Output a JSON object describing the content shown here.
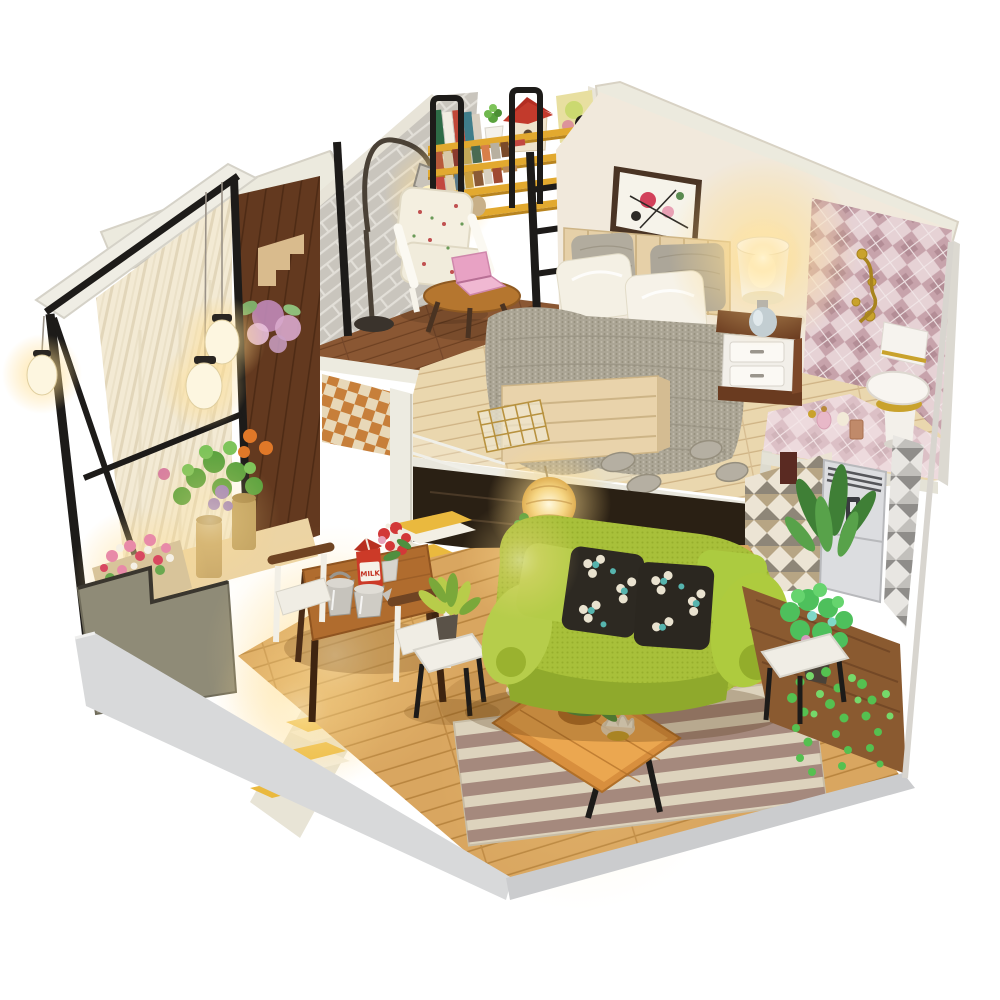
{
  "meta": {
    "type": "product-photo",
    "subject": "DIY miniature dollhouse kit — two-storey loft apartment with lights",
    "background": "#ffffff"
  },
  "labels": {
    "milk_carton": "MILK"
  },
  "palette": {
    "exterior_wall": "#eceade",
    "brick_wall": "#c9c5bd",
    "dark_wood_wall": "#63391f",
    "shelf_yellow": "#e2a92f",
    "frame_black": "#1d1b19",
    "bedroom_wall": "#f1e9dc",
    "argyle_tile_base": "#e6d2d5",
    "argyle_diamond": "#c7a3ab",
    "gold_fixture": "#c9a22c",
    "loft_wood": "#ead7ae",
    "nook_wood": "#8a5733",
    "floor_wood": "#d9a660",
    "stair_yellow": "#eab93e",
    "curtain_cream": "#f3ead4",
    "blanket_gray": "#aba595",
    "satin_white": "#f4f0e4",
    "sofa_green": "#a8c03a",
    "cushion_dark": "#2d2922",
    "cushion_flower_white": "#e9e2cf",
    "cushion_flower_teal": "#56b4ae",
    "rug_cream": "#ddd3bd",
    "rug_stripe": "#a5897d",
    "coffee_table": "#d88f3e",
    "milk_red": "#cc3a28",
    "kettle_silver": "#c6c3bc",
    "plant_green": "#57a93c",
    "vine_green": "#55c050",
    "ac_silver": "#dcdde0",
    "toilet_white": "#f6f3ee",
    "lamp_glow": "#ffd98a",
    "base_edge": "#d4d5d6"
  },
  "scene": {
    "areas": [
      {
        "name": "reading-nook",
        "objects": [
          "brick-wall",
          "bookshelf",
          "book-row",
          "succulent-pot",
          "red-birdhouse",
          "art-poster",
          "arc-floor-lamp",
          "floral-armchair",
          "round-side-table",
          "pink-laptop"
        ]
      },
      {
        "name": "bedroom-loft",
        "objects": [
          "abstract-wall-art",
          "slatted-bed",
          "knit-blanket",
          "knit-pillows",
          "satin-pillows",
          "nightstand",
          "table-lamp",
          "knit-slippers",
          "wire-basket",
          "pattern-rug",
          "guard-ladder",
          "acrylic-stair-rail"
        ]
      },
      {
        "name": "bathroom-corner",
        "objects": [
          "argyle-tile-wall",
          "gold-towel-hook",
          "toilet",
          "perfume-bottles",
          "pink-tile-counter"
        ]
      },
      {
        "name": "living-room",
        "objects": [
          "green-sofa",
          "floral-cushions",
          "paper-lantern",
          "plank-coffee-table",
          "berry-centerpiece",
          "lotus-candle-holders",
          "striped-rug",
          "white-side-table",
          "potted-plant",
          "plant-stand",
          "trailing-vine",
          "air-conditioner",
          "triangle-wallpaper"
        ]
      },
      {
        "name": "dining-area",
        "objects": [
          "wooden-dining-table",
          "milk-carton",
          "silver-kettles",
          "red-flower-vase",
          "dining-chair-left",
          "dining-chair-right"
        ]
      },
      {
        "name": "balcony",
        "objects": [
          "white-top-board",
          "black-metal-frame",
          "striped-curtains",
          "hanging-lanterns",
          "flower-decal-wood-wall",
          "potted-roses",
          "purple-flowers",
          "pink-flower-planter",
          "yellow-stairs",
          "stepped-ledge"
        ]
      }
    ],
    "lighting": [
      "warm LED glow at bedside lamp",
      "arc lamp over armchair",
      "paper lantern under loft",
      "balcony lantern trio",
      "planter spotlights"
    ]
  }
}
